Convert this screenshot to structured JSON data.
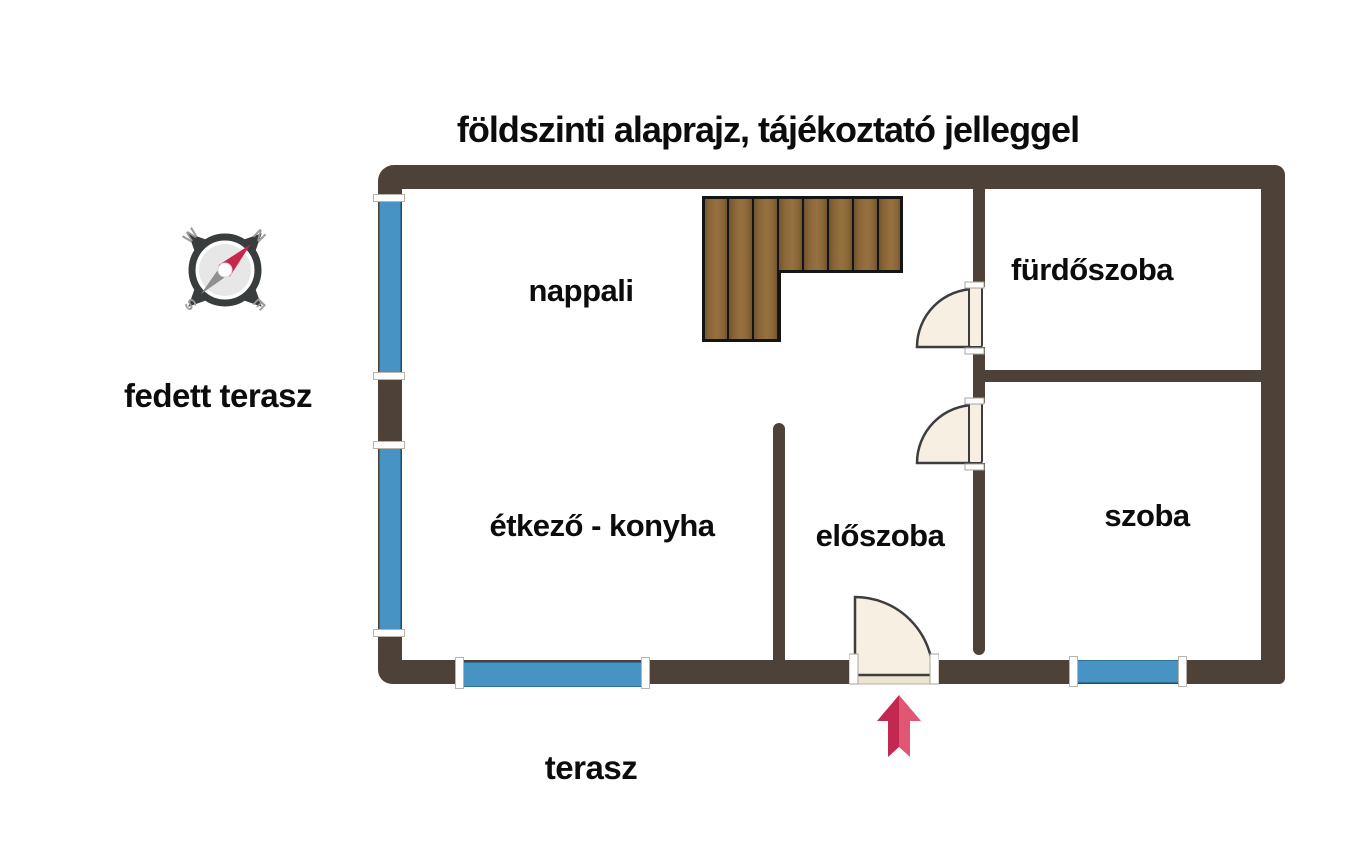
{
  "title": "földszinti alaprajz, tájékoztató jelleggel",
  "outside_labels": {
    "covered_terrace": "fedett terasz",
    "terrace": "terasz"
  },
  "rooms": {
    "living": {
      "label": "nappali"
    },
    "bathroom": {
      "label": "fürdőszoba"
    },
    "kitchen_dining": {
      "label": "étkező - konyha"
    },
    "hallway": {
      "label": "előszoba"
    },
    "room": {
      "label": "szoba"
    }
  },
  "compass": {
    "n": "N",
    "e": "E",
    "s": "S",
    "w": "W"
  },
  "colors": {
    "text": "#0c0c0c",
    "wall": "#4e4238",
    "window_blue": "#4793c3",
    "window_border": "#2f6e95",
    "sill_white": "#ffffff",
    "door_fill": "#f6efe2",
    "door_outline": "#3d3d3d",
    "threshold": "#ece3d1",
    "wood_light": "#96713f",
    "wood_mid": "#8a6637",
    "wood_dark": "#6b5130",
    "wood_outline": "#151515",
    "arrow_dark": "#c32950",
    "arrow_light": "#e15672",
    "compass_dark": "#3a3d3e",
    "compass_face": "#e7e7e7",
    "compass_gray": "#9b9b9b",
    "needle_red": "#c8274c",
    "needle_gray": "#8f8f8f"
  }
}
